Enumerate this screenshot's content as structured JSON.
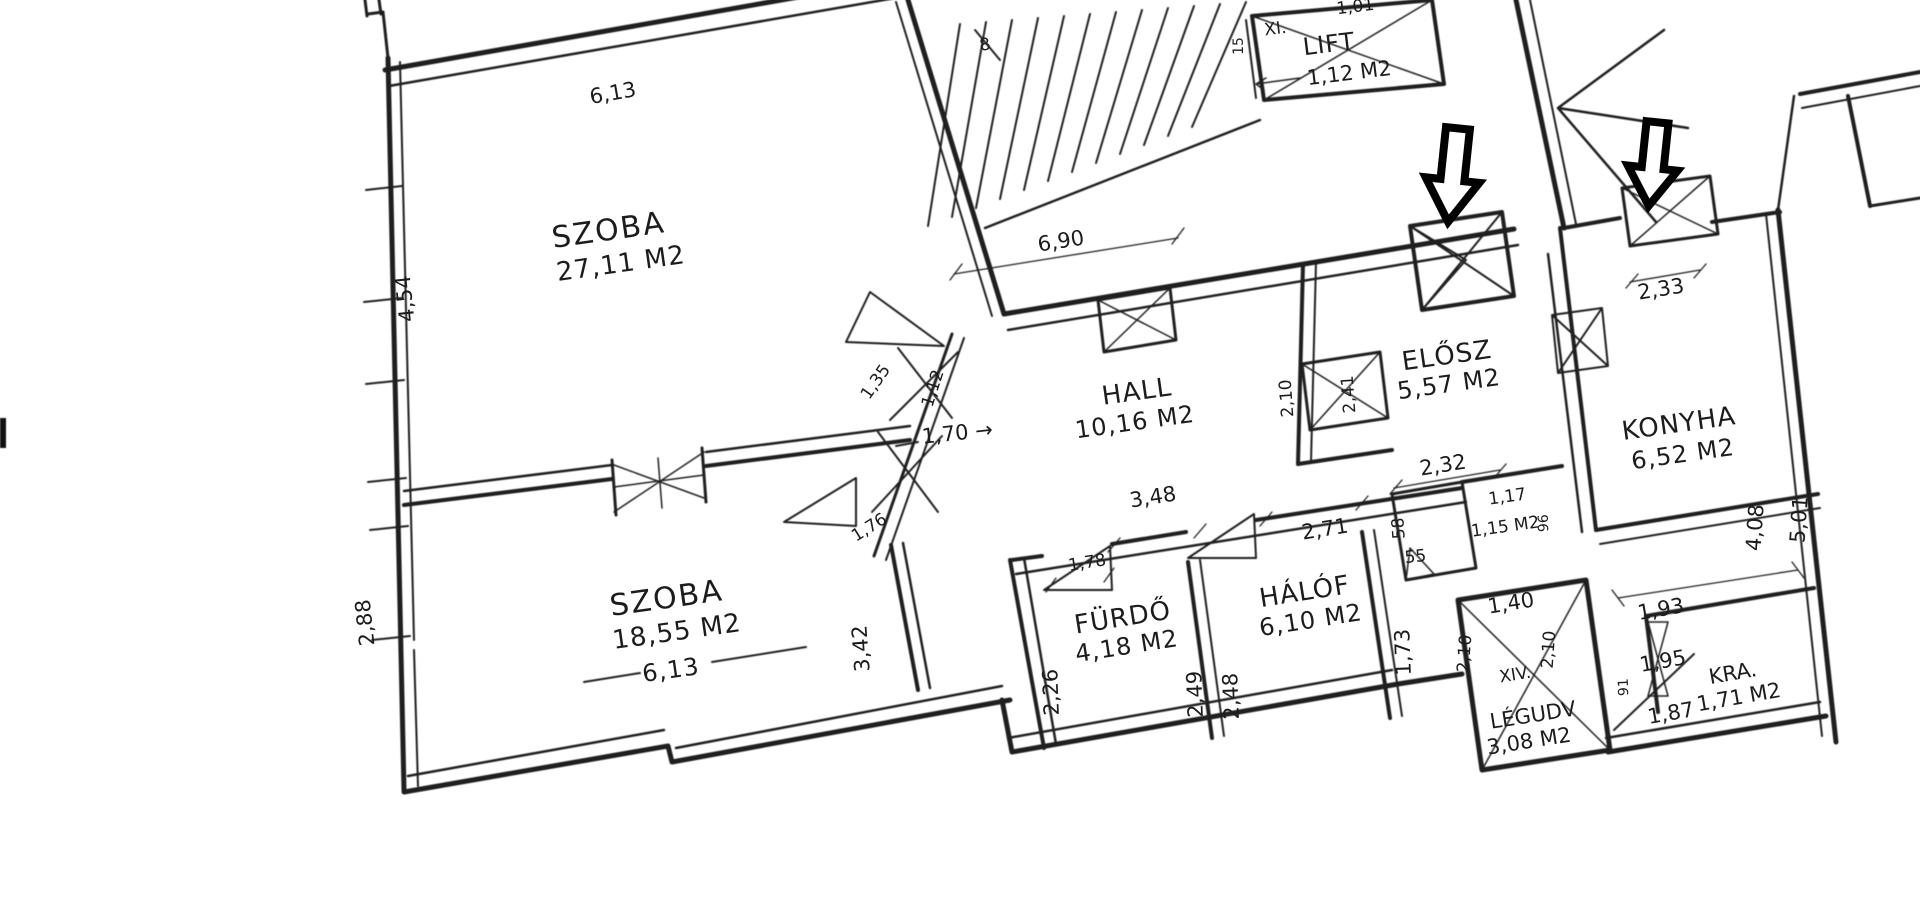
{
  "document": {
    "kind": "scanned hand-drawn apartment floor plan"
  },
  "colors": {
    "ink": "#1f1f1f",
    "paper": "#ffffff",
    "arrow_fill": "#ffffff",
    "arrow_stroke": "#000000"
  },
  "plan": {
    "rooms": {
      "szoba1": {
        "name": "SZOBA",
        "area": "27,11 M2"
      },
      "szoba2": {
        "name": "SZOBA",
        "area": "18,55 M2"
      },
      "hall": {
        "name": "HALL",
        "area": "10,16 M2"
      },
      "elosz": {
        "name": "ELŐSZ",
        "area": "5,57 M2"
      },
      "konyha": {
        "name": "KONYHA",
        "area": "6,52 M2"
      },
      "furdo": {
        "name": "FÜRDŐ",
        "area": "4,18 M2"
      },
      "halof": {
        "name": "HÁLÓF",
        "area": "6,10 M2"
      },
      "lift": {
        "name": "LIFT",
        "area": "1,12 M2"
      },
      "legudv": {
        "name": "LÉGUDV",
        "area": "3,08 M2"
      },
      "kamra": {
        "name": "KRA.",
        "area": "1,71 M2"
      },
      "wc": {
        "area": "1,15 M2"
      }
    },
    "dims": {
      "szoba1_width": "6,13",
      "szoba1_height": "4,54",
      "szoba2_width": "6,13",
      "szoba2_height": "2,88",
      "stair_hall": "6,90",
      "hall_entry": "1,70 →",
      "diag_upper": "1,35",
      "diag_lower": "1,12",
      "niche_width": "1,76",
      "niche_height": "3,42",
      "hall_door": "2,10",
      "elosz_door": "2,41",
      "wc_top": "2,32",
      "wc_side_upper": "58",
      "wc_side_lower": "55",
      "wc_width": "1,17",
      "wc_depth": "96",
      "hall_south": "3,48",
      "furdo_door": "1,78",
      "halof_top": "2,71",
      "furdo_left": "2,26",
      "furdo_right": "2,49",
      "halof_left": "2,48",
      "halof_right": "1,73",
      "konyha_window": "2,33",
      "konyha_depth_inner": "4,08",
      "konyha_depth_outer": "5,01",
      "legudv_top": "1,40",
      "legudv_left": "2,10",
      "legudv_right": "2,10",
      "kamra_top": "1,93",
      "pass_diag_upper": "1,95",
      "pass_side": "91",
      "pass_diag_lower": "1,87",
      "top_edge_partial": "1,01"
    },
    "tags": {
      "floor_upper": "XI.",
      "floor_lower": "XIV.",
      "lift_side": "15",
      "stair_mark": "8"
    }
  }
}
